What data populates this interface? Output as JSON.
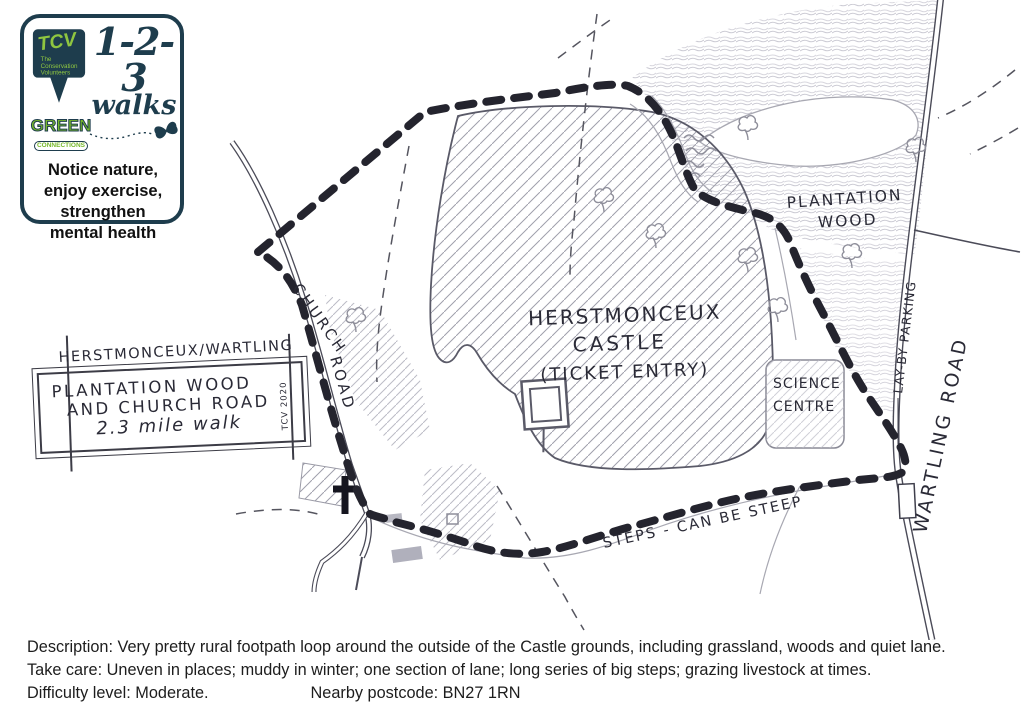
{
  "logo": {
    "tcv": "TCV",
    "tcv_sub1": "The",
    "tcv_sub2": "Conservation",
    "tcv_sub3": "Volunteers",
    "one_two_three": "1-2-3",
    "walks": "walks",
    "green": "GREEN",
    "connections": "CONNECTIONS",
    "tagline": [
      "Notice nature,",
      "enjoy exercise,",
      "strengthen",
      "mental health"
    ]
  },
  "sign": {
    "heading": "HERSTMONCEUX/WARTLING",
    "line1": "PLANTATION WOOD",
    "line2": "AND CHURCH ROAD",
    "line3": "2.3 mile walk",
    "credit": "TCV 2020"
  },
  "map": {
    "labels": {
      "church": "CHURCH",
      "road": "ROAD",
      "castle_line1": "HERSTMONCEUX",
      "castle_line2": "CASTLE",
      "castle_line3": "(TICKET ENTRY)",
      "plantation_line1": "PLANTATION",
      "plantation_line2": "WOOD",
      "science_line1": "SCIENCE",
      "science_line2": "CENTRE",
      "layby": "LAY-BY PARKING",
      "wartling": "WARTLING ROAD",
      "steps": "STEPS - CAN BE STEEP"
    }
  },
  "footer": {
    "description": "Description: Very pretty rural footpath loop around the outside of the Castle grounds, including grassland, woods and quiet lane.",
    "take_care": "Take care: Uneven in places; muddy in winter; one section of lane; long series of big steps; grazing livestock at times.",
    "difficulty": "Difficulty level: Moderate.",
    "postcode": "Nearby postcode: BN27 1RN"
  },
  "colors": {
    "ink": "#2a2a36",
    "route": "#24242e",
    "pencil": "#8e8e9a",
    "navy": "#1e3d4d",
    "green": "#76b82a"
  }
}
